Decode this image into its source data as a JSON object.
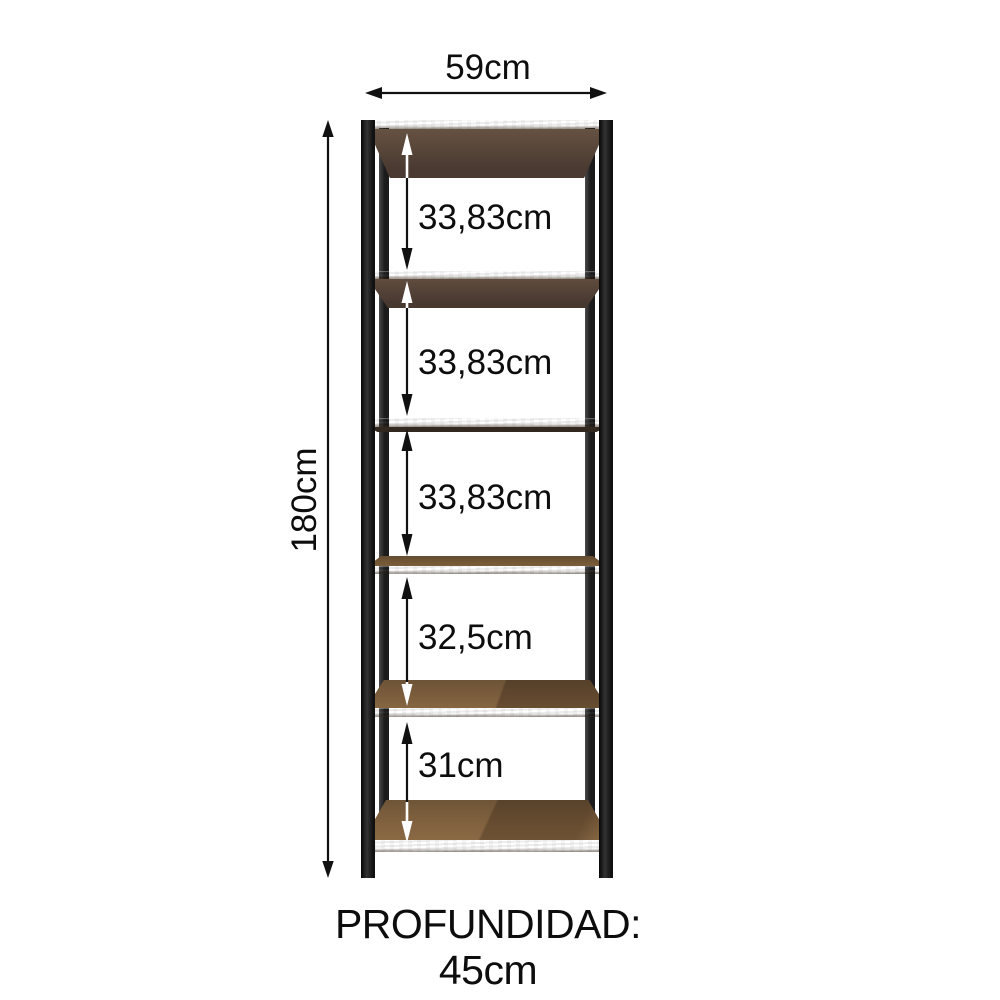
{
  "diagram": {
    "width": {
      "label": "59cm"
    },
    "height": {
      "label": "180cm"
    },
    "depth_label": "PROFUNDIDAD: 45cm",
    "gaps": [
      {
        "label": "33,83cm"
      },
      {
        "label": "33,83cm"
      },
      {
        "label": "33,83cm"
      },
      {
        "label": "32,5cm"
      },
      {
        "label": "31cm"
      }
    ],
    "shelf_count": 6,
    "colors": {
      "frame": "#1c1c1c",
      "wood_top": "#82623f",
      "wood_edge": "#a57c4b",
      "wood_underside": "#524036",
      "dimension_line": "#111111",
      "background": "#ffffff",
      "text": "#0d0d0d"
    }
  }
}
